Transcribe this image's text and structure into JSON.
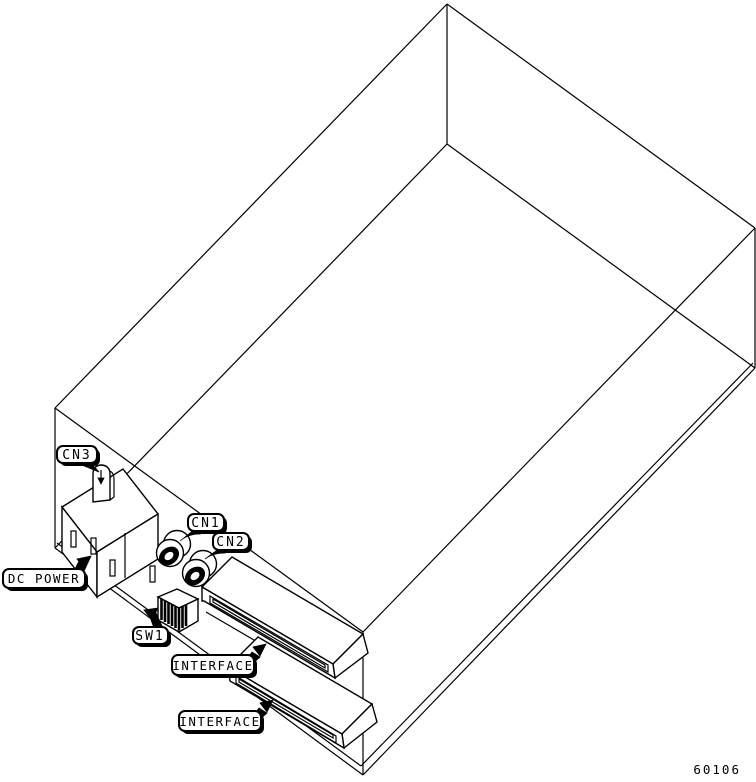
{
  "figure": {
    "number": "60106"
  },
  "callouts": [
    {
      "id": "cn3",
      "text": "CN3"
    },
    {
      "id": "cn1",
      "text": "CN1"
    },
    {
      "id": "cn2",
      "text": "CN2"
    },
    {
      "id": "dc_power",
      "text": "DC POWER"
    },
    {
      "id": "sw1",
      "text": "SW1"
    },
    {
      "id": "interface_1",
      "text": "INTERFACE"
    },
    {
      "id": "interface_2",
      "text": "INTERFACE"
    }
  ],
  "colors": {
    "line": "#000000",
    "background": "#ffffff",
    "label_fill": "#ffffff",
    "label_border": "#000000",
    "label_shadow": "#000000"
  }
}
